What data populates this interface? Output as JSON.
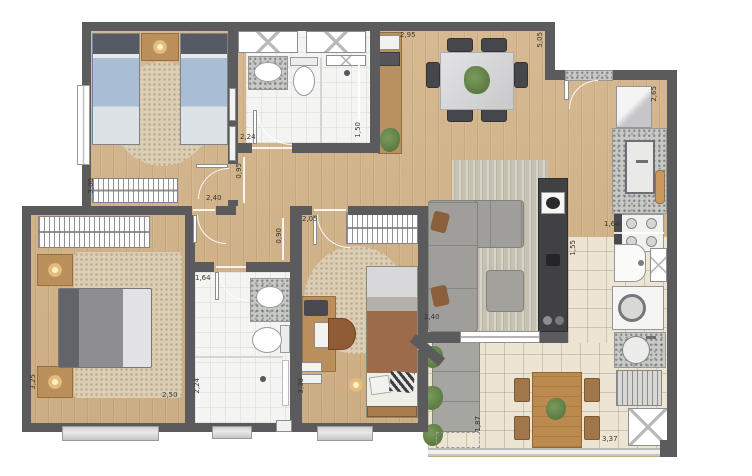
{
  "dims": [
    "2,95",
    "5,05",
    "2,65",
    "1,50",
    "2,24",
    "0,95",
    "2,40",
    "3,00",
    "2,05",
    "0,90",
    "1,64",
    "1,55",
    "2,40",
    "1,64",
    "2,24",
    "3,30",
    "3,25",
    "2,50",
    "1,87",
    "3,37"
  ],
  "colors": {
    "wall": "#5b5b5d",
    "wood_floor": "#d0b38d",
    "tile_floor": "#ece5d4",
    "bath_floor": "#f4f4f2",
    "granite": "#c7c9c7",
    "rug": "#dbceb5",
    "bed_blue": "#a9bed4",
    "blanket_gray": "#8e8e92",
    "blanket_brown": "#9b6b4c",
    "sofa_gray": "#a09e9a",
    "furniture_wood": "#bb8f5c",
    "plant_green": "#57783f",
    "dim_text": "#3a342c"
  }
}
